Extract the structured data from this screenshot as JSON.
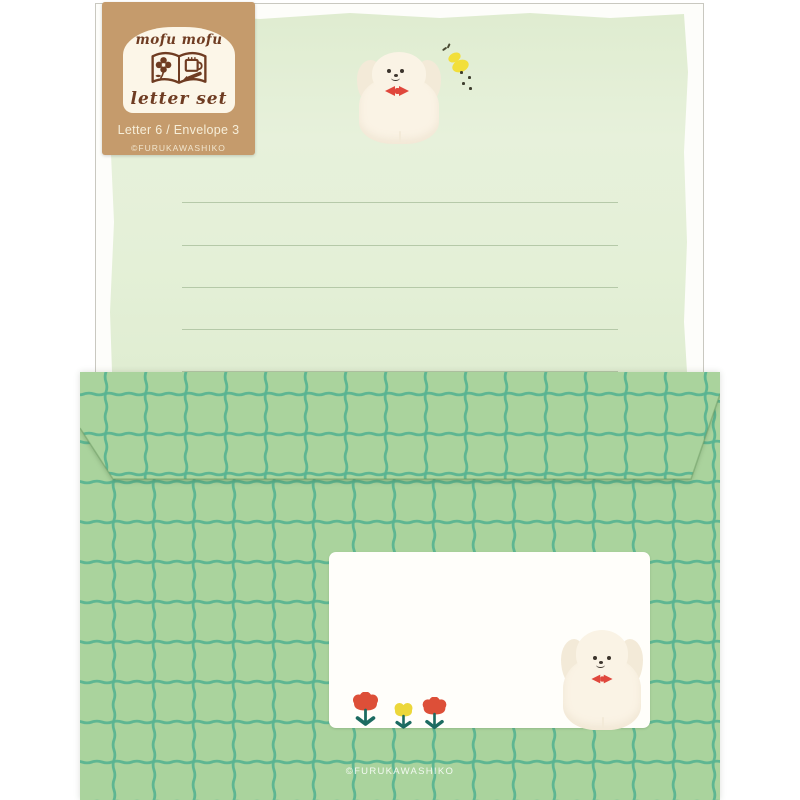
{
  "product": {
    "tag": {
      "brand": "mofu mofu",
      "title": "letter set",
      "contents": "Letter 6 / Envelope 3",
      "copyright": "©FURUKAWASHIKO"
    },
    "envelope": {
      "copyright": "©FURUKAWASHIKO"
    }
  },
  "icons": {
    "tag_emblem": "open-book-with-flower-mug-and-pencil",
    "letter_paper_dog": "fluffy-white-puppy-with-red-bow",
    "butterfly": "yellow-butterfly-with-dotted-trail",
    "envelope_dog": "fluffy-white-puppy-with-red-bow",
    "flowers": [
      "red-tulip",
      "yellow-tulip",
      "red-tulip"
    ]
  },
  "colors": {
    "kraft": "#c59b6c",
    "cream": "#fcf6e8",
    "brown": "#6f3c22",
    "tagtext": "#f6eed9",
    "paper": "#e4f0d7",
    "papertop": "#dfecd0",
    "ruleline": "#adc2a0",
    "backing": "#fdfdfa",
    "backingedge": "#c9c8c0",
    "envgreen": "#aad39d",
    "gridteal": "#58b392",
    "labelwhite": "#fffefa",
    "dogcream": "#faf3e5",
    "dogshade": "#f3ead8",
    "dogface": "#3c342c",
    "bowred": "#e0473c",
    "butteryellow": "#f2df3a",
    "flowerred": "#dd4f38",
    "floweryellow": "#ecd73a",
    "stemteal": "#1c6b61"
  }
}
